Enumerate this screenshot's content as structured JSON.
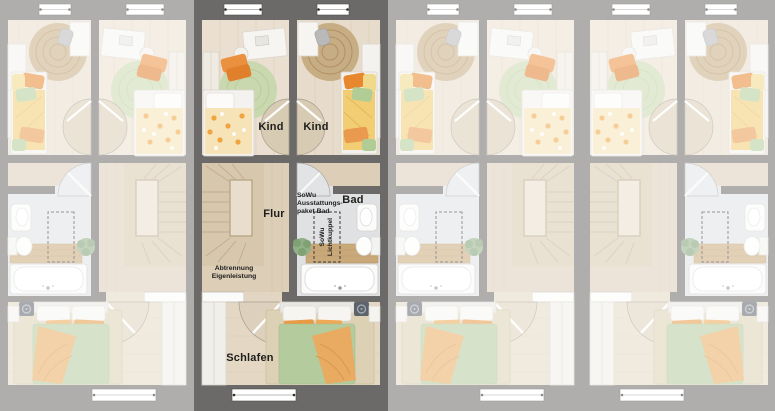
{
  "floorplan": {
    "kind": "townhouse-upper-floor-plan",
    "units_count": 4,
    "highlighted_unit": 2,
    "labels": {
      "kind_left": "Kind",
      "kind_right": "Kind",
      "flur": "Flur",
      "bad": "Bad",
      "schlafen": "Schlafen",
      "sowu_bad": {
        "line1": "SoWu",
        "line2": "Ausstattungs-",
        "line3": "paket Bad"
      },
      "lichtkuppel": {
        "line1": "SoWu",
        "line2": "Lichtkuppel"
      },
      "abtrennung": {
        "line1": "Abtrennung",
        "line2": "Eigenleistung"
      }
    },
    "colors": {
      "wall": "#6b6a68",
      "kid_room_floor": "#eadfd0",
      "hall_floor": "#ddceb8",
      "bedroom_floor": "#e4d8c5",
      "bath_floor": "#e0e1e3",
      "stairs_wood": "#d7c7ad",
      "furniture_white": "#f4f2ee",
      "accent_orange": "#e8913f",
      "accent_green": "#b3cb9d",
      "accent_yellow": "#f2cd74",
      "rug_green": "#c9d8ae",
      "rug_jute": "#c7ad83",
      "rug_beige": "#dcd1b4",
      "label_text": "#1d1d1b",
      "dim_overlay": "rgba(255,255,255,0.46)"
    }
  }
}
